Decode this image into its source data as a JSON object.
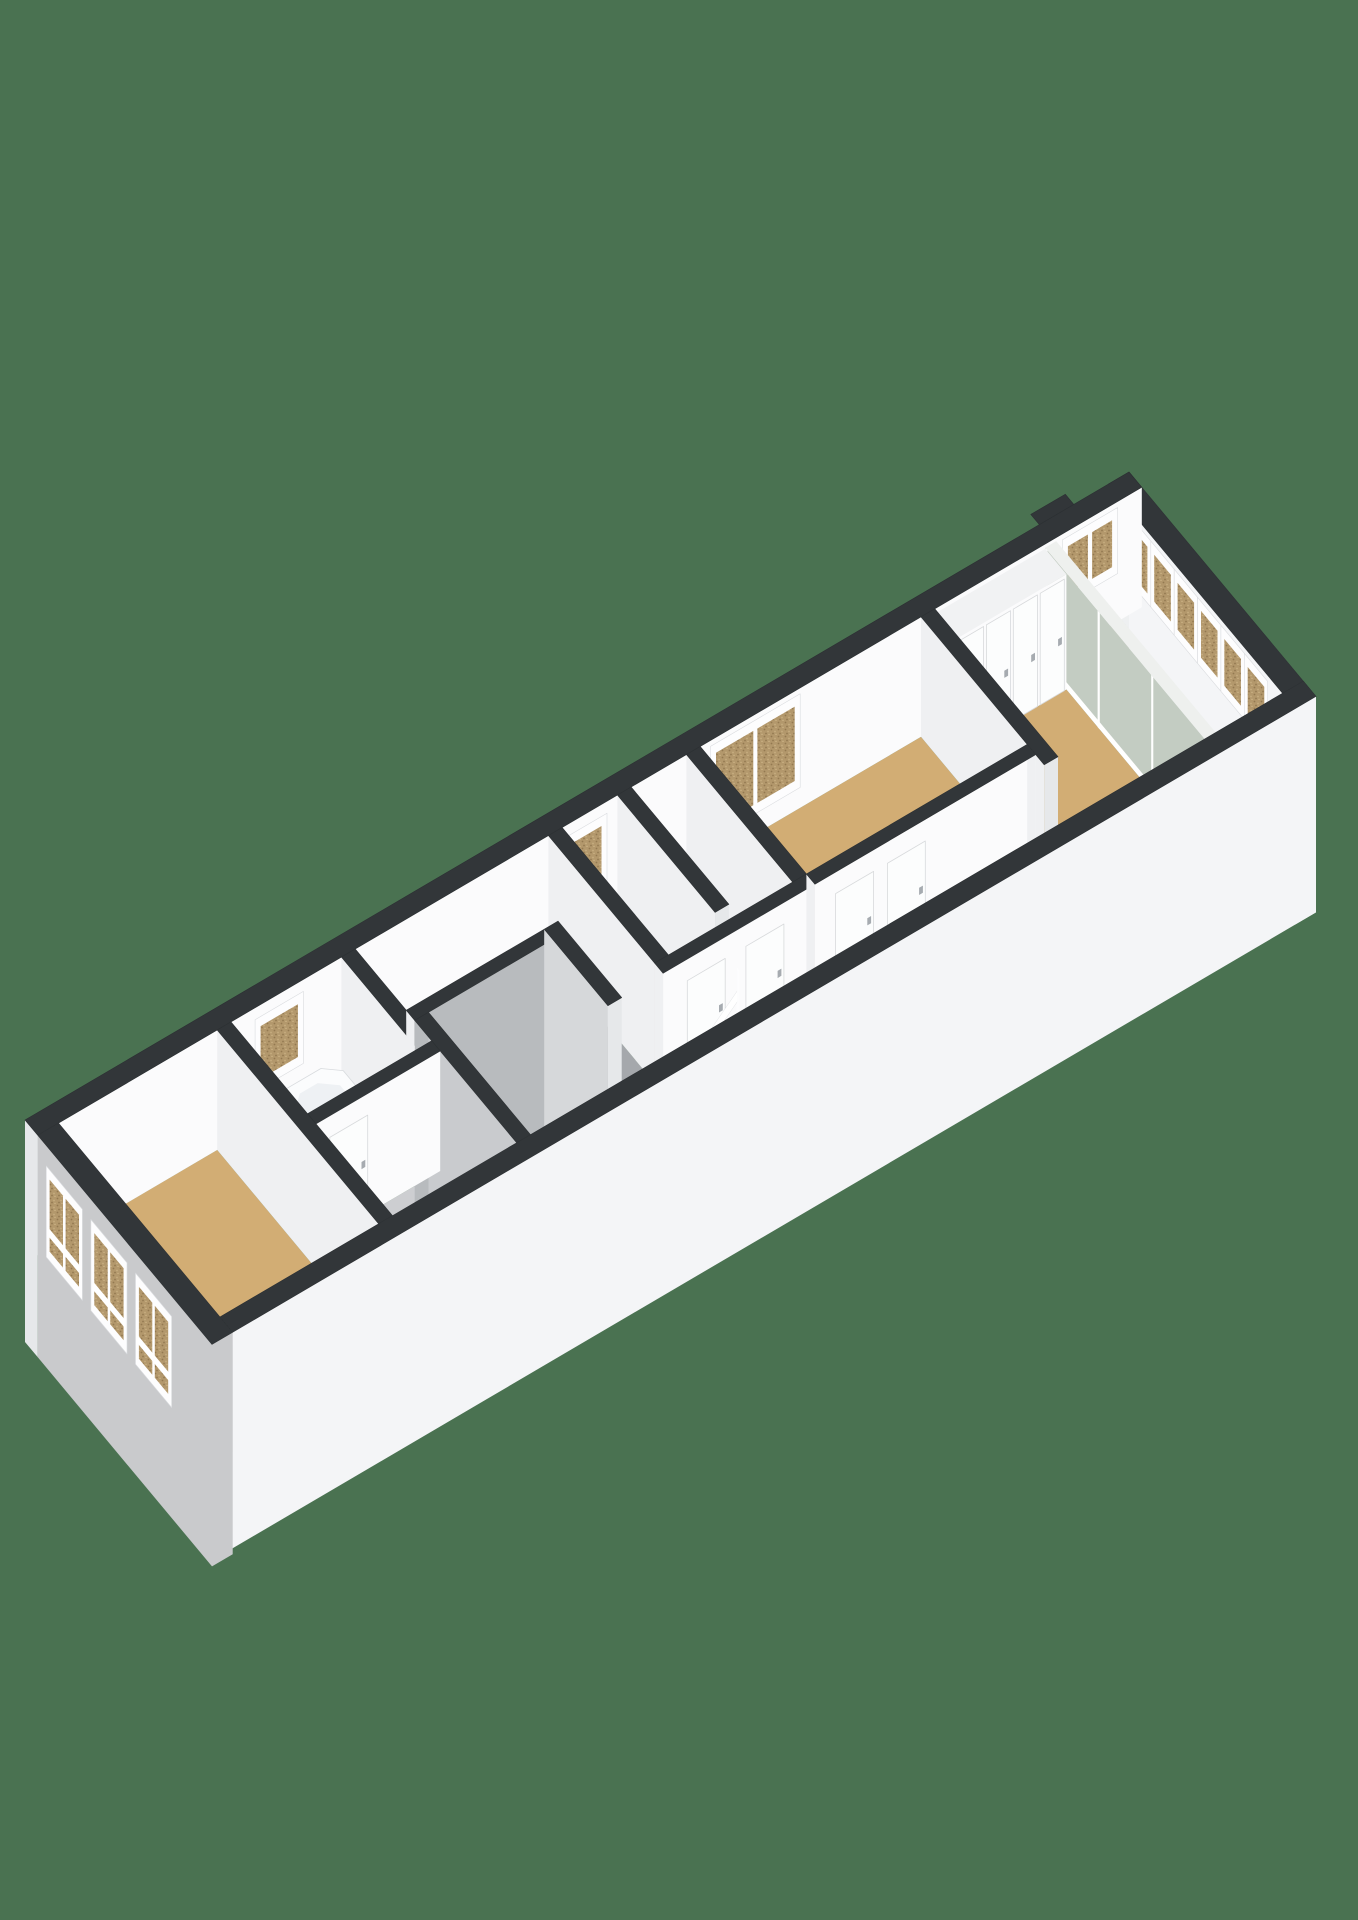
{
  "image_kind": "3d-floorplan-render",
  "visible_text": [],
  "colors": {
    "bg": "#4a7251",
    "darkTop": "#323639",
    "darkTopEdge": "#2c3033",
    "white": "#ffffff",
    "facade": "#c9cacc",
    "faceOuterWhite": "#f4f5f7",
    "faceInnerWhite": "#fbfbfc",
    "faceInnerLight": "#eef0f1",
    "faceInnerGray": "#a7aaae",
    "faceSideLight": "#eff0f2",
    "faceEnd": "#e6e8ea",
    "wardrobeTop": "#f1f2f3",
    "voidFaceA": "#b8bbbe",
    "voidFaceB": "#d6d8da",
    "voidFaceC": "#c9cbce",
    "glassGreen": "#c3ccc2",
    "glassGray": "#cfd6dc",
    "glassTopRail": "#eef0ee",
    "floorTan": "#d2ad74",
    "floorBath": "#c8d2dd",
    "floorHallLight": "#cdced1",
    "floorHallMid": "#bfc1c4",
    "floorHallDark": "#a5a8ac",
    "floorBalcony": "#b6b8aa",
    "treadA": "#f4f5f7",
    "treadB": "#eceef0",
    "treadNose": "#f0f2f4",
    "riser": "#dfe2e4",
    "doorLeaf": "#fcfdfd",
    "doorEdge": "#d8dadc",
    "handle": "#a6abb0",
    "winFrame": "#fdfdfe",
    "winFrameEdge": "#dadcdf",
    "glassSpeckBase": "#b3986c",
    "glassSpeckDark": "#937950",
    "glassSpeckLight": "#c7ad80",
    "carpetBase": "#a49e92",
    "carpetDark": "#8b857a",
    "carpetLight": "#b5afa3",
    "tubOuter": "#fbfcfd",
    "tubRim": "#d8dbde",
    "tubInner": "#eef1f4",
    "tubFloor": "#e6eaee",
    "tubSideS": "#eff1f3",
    "tubSideW": "#f4f6f8"
  },
  "scene": {
    "proj": {
      "ox": 25,
      "oy": 1240,
      "ax": 6.9,
      "ay": -4.05,
      "bx": 4.25,
      "by": 5.1,
      "ez": 120
    },
    "build": [
      {
        "t": "floor",
        "name": "floor-bedroom-front",
        "r": [
          3,
          3,
          26,
          41
        ],
        "f": "floorTan"
      },
      {
        "t": "floor",
        "name": "floor-bathroom",
        "r": [
          28,
          3,
          44,
          21
        ],
        "f": "floorBath"
      },
      {
        "t": "floor",
        "name": "floor-hall-west",
        "r": [
          28,
          23,
          46,
          41
        ],
        "f": "floorHallLight"
      },
      {
        "t": "floor",
        "name": "floor-hall-north",
        "r": [
          46,
          3,
          74,
          15
        ],
        "f": "floorHallMid"
      },
      {
        "t": "floor",
        "name": "floor-hall-east",
        "r": [
          68,
          15,
          74,
          30
        ],
        "f": "floorHallDark"
      },
      {
        "t": "floor",
        "name": "floor-closet-a",
        "r": [
          76,
          3,
          84,
          26
        ],
        "f": "floorHallMid"
      },
      {
        "t": "floor",
        "name": "floor-closet-b",
        "r": [
          86,
          3,
          94,
          26
        ],
        "f": "floorHallLight"
      },
      {
        "t": "floor",
        "name": "floor-bedroom-middle",
        "r": [
          96,
          3,
          128,
          28
        ],
        "f": "floorTan"
      },
      {
        "t": "floor",
        "name": "floor-stair-landing",
        "r": [
          84,
          30,
          96,
          41
        ],
        "f": "floorTan"
      },
      {
        "t": "floor",
        "name": "floor-corridor",
        "r": [
          96,
          30,
          128,
          41
        ],
        "f": "floorHallDark"
      },
      {
        "t": "floor",
        "name": "floor-bedroom-back",
        "r": [
          130,
          8,
          146,
          41
        ],
        "f": "floorTan"
      },
      {
        "t": "floor",
        "name": "floor-balcony",
        "r": [
          147.6,
          3,
          157,
          41
        ],
        "f": "floorBalcony"
      },
      {
        "t": "wall",
        "name": "wall-exterior-northeast",
        "r": [
          157,
          0,
          160,
          44
        ],
        "h": 1,
        "top": "darkTop",
        "faces": [
          {
            "s": "W",
            "f": "faceInnerLight"
          },
          {
            "s": "E",
            "f": "faceOuterWhite",
            "b": -0.8
          },
          {
            "s": "S",
            "f": "faceOuterWhite",
            "b": -0.8
          }
        ]
      },
      {
        "t": "wins",
        "name": "balcony-window-band",
        "plane": "x",
        "at": 157,
        "z": [
          0.45,
          0.9
        ],
        "glass": "gspeck",
        "items": [
          {
            "span": [
              5,
              9.5
            ]
          },
          {
            "span": [
              10.5,
              15
            ]
          },
          {
            "span": [
              16,
              20.5
            ]
          },
          {
            "span": [
              21.5,
              26
            ]
          },
          {
            "span": [
              27,
              31.5
            ]
          },
          {
            "span": [
              32.5,
              37
            ]
          }
        ]
      },
      {
        "t": "wall",
        "name": "wall-exterior-northwest",
        "r": [
          0,
          0,
          160,
          3
        ],
        "h": 1,
        "top": "darkTop",
        "faces": [
          {
            "s": "W",
            "f": "faceEnd",
            "b": -0.85
          },
          {
            "s": "S",
            "f": "faceInnerWhite"
          }
        ]
      },
      {
        "t": "wins",
        "name": "bathroom-window",
        "plane": "y",
        "at": 3,
        "z": [
          0.35,
          0.85
        ],
        "glass": "gspeck",
        "items": [
          {
            "span": [
              32,
              38
            ]
          }
        ]
      },
      {
        "t": "wins",
        "name": "closet-window",
        "plane": "y",
        "at": 3,
        "z": [
          0.3,
          0.85
        ],
        "glass": "gspeck",
        "items": [
          {
            "span": [
              76,
              82
            ]
          }
        ]
      },
      {
        "t": "wins",
        "name": "bedroom-middle-window",
        "plane": "y",
        "at": 3,
        "z": [
          0.22,
          0.9
        ],
        "glass": "gspeck",
        "items": [
          {
            "span": [
              98,
              110
            ],
            "mull": [
              104
            ]
          }
        ]
      },
      {
        "t": "wins",
        "name": "balcony-corner-window",
        "plane": "y",
        "at": 3,
        "z": [
          0.45,
          0.9
        ],
        "glass": "gspeck",
        "items": [
          {
            "span": [
              149,
              156
            ],
            "mull": [
              152.5
            ]
          }
        ]
      },
      {
        "t": "top",
        "name": "roof-vent",
        "r": [
          147,
          -2,
          152,
          0
        ],
        "z": 1,
        "f": "darkTop"
      },
      {
        "t": "glasswall",
        "name": "glass-sliding-wall",
        "r": [
          146,
          3,
          147.6,
          41
        ],
        "h": 0.97,
        "divs": [
          3.3,
          15.6,
          28.2,
          40.7
        ]
      },
      {
        "t": "wall",
        "name": "wardrobe",
        "r": [
          130,
          3,
          146,
          8
        ],
        "h": 0.96,
        "top": "wardrobeTop",
        "faces": [
          {
            "s": "W",
            "f": "faceOuterWhite"
          },
          {
            "s": "S",
            "f": "faceInnerWhite"
          }
        ]
      },
      {
        "t": "doors",
        "name": "wardrobe-door",
        "plane": "y",
        "at": 8,
        "h": 0.93,
        "items": [
          [
            130.5,
            134
          ],
          [
            134.4,
            137.9
          ],
          [
            138.3,
            141.8
          ],
          [
            142.2,
            145.7
          ]
        ]
      },
      {
        "t": "wall",
        "name": "wall-back-bedroom-west",
        "r": [
          128,
          3,
          130,
          32
        ],
        "h": 1,
        "top": "darkTop",
        "faces": [
          {
            "s": "W",
            "f": "faceSideLight"
          },
          {
            "s": "S",
            "f": "faceEnd"
          }
        ]
      },
      {
        "t": "wall",
        "name": "wall-bedroom-middle-east",
        "r": [
          94,
          3,
          96,
          28
        ],
        "h": 1,
        "top": "darkTop",
        "faces": [
          {
            "s": "W",
            "f": "faceSideLight"
          },
          {
            "s": "S",
            "f": "faceEnd"
          }
        ]
      },
      {
        "t": "wall",
        "name": "wall-closet-divider",
        "r": [
          84,
          3,
          86,
          26
        ],
        "h": 1,
        "top": "darkTop",
        "faces": [
          {
            "s": "W",
            "f": "faceSideLight"
          },
          {
            "s": "S",
            "f": "faceEnd"
          }
        ]
      },
      {
        "t": "wall",
        "name": "wall-hall-closet",
        "r": [
          74,
          3,
          76,
          28
        ],
        "h": 1,
        "top": "darkTop",
        "faces": [
          {
            "s": "W",
            "f": "faceSideLight"
          },
          {
            "s": "S",
            "f": "faceEnd"
          }
        ]
      },
      {
        "t": "wall",
        "name": "wall-bathroom-east",
        "r": [
          44,
          3,
          46,
          21
        ],
        "h": 1,
        "top": "darkTop",
        "faces": [
          {
            "s": "W",
            "f": "faceSideLight"
          },
          {
            "s": "S",
            "f": "faceEnd"
          }
        ]
      },
      {
        "t": "wall",
        "name": "shower-screen",
        "r": [
          29,
          4.5,
          30.2,
          12
        ],
        "h": 0.55,
        "top": "white",
        "faces": [
          {
            "s": "W",
            "f": "glassGray"
          },
          {
            "s": "S",
            "f": "glassGray"
          }
        ]
      },
      {
        "t": "wall",
        "name": "stairwell-wall-north",
        "r": [
          46,
          15,
          66,
          17
        ],
        "h": 1,
        "top": "darkTop",
        "faces": [
          {
            "s": "S",
            "f": "voidFaceA",
            "b": -0.95
          },
          {
            "s": "W",
            "f": "faceSideLight"
          }
        ]
      },
      {
        "t": "wall",
        "name": "stairwell-wall-east",
        "r": [
          66,
          15,
          68,
          30
        ],
        "h": 1,
        "top": "darkTop",
        "faces": [
          {
            "s": "W",
            "f": "voidFaceB",
            "b": -0.95
          },
          {
            "s": "S",
            "f": "faceEnd",
            "b": -0.95
          }
        ]
      },
      {
        "t": "wall",
        "name": "stairwell-wall-west",
        "r": [
          46,
          17,
          48,
          41
        ],
        "h": 1,
        "top": "darkTop",
        "faces": [
          {
            "s": "E",
            "f": "voidFaceC",
            "b": -0.95
          },
          {
            "s": "S",
            "f": "faceInnerWhite"
          }
        ]
      },
      {
        "t": "top",
        "name": "stair-carpet",
        "r": [
          48,
          30,
          55.5,
          41
        ],
        "z": -0.75,
        "f": "url(#carpet)"
      },
      {
        "t": "wall",
        "name": "wall-closet-south",
        "r": [
          74,
          28,
          96,
          30
        ],
        "h": 1,
        "top": "darkTop",
        "faces": [
          {
            "s": "W",
            "f": "faceSideLight"
          },
          {
            "s": "S",
            "f": "faceInnerWhite"
          }
        ]
      },
      {
        "t": "doors",
        "name": "closet-door",
        "plane": "y",
        "at": 30,
        "h": 0.82,
        "items": [
          [
            77.5,
            83
          ],
          [
            86,
            91.5
          ]
        ]
      },
      {
        "t": "wall",
        "name": "wall-bedroom-middle-south",
        "r": [
          96,
          28,
          128,
          30
        ],
        "h": 1,
        "top": "darkTop",
        "faces": [
          {
            "s": "W",
            "f": "faceSideLight"
          },
          {
            "s": "S",
            "f": "faceInnerWhite"
          },
          {
            "s": "E",
            "f": "faceSideLight"
          }
        ]
      },
      {
        "t": "doors",
        "name": "bedroom-middle-door",
        "plane": "y",
        "at": 30,
        "h": 0.82,
        "items": [
          [
            99,
            104.5
          ],
          [
            106.5,
            112
          ]
        ]
      },
      {
        "t": "stairs",
        "name": "staircase",
        "x0": 84,
        "n": 8,
        "w": 2.1,
        "y": [
          30,
          41
        ],
        "z0": -0.06,
        "dz": 0.105
      },
      {
        "t": "rail",
        "name": "stair-balustrade",
        "x": [
          67.2,
          84.6
        ],
        "y": 30.5,
        "posts": 9,
        "ph": 0.56,
        "x0": 84,
        "w": 2.1,
        "z0": -0.06,
        "dz": 0.105
      },
      {
        "t": "tub",
        "name": "bathtub",
        "r": [
          32.5,
          5.5,
          41.5,
          18.5
        ]
      },
      {
        "t": "wall",
        "name": "wall-bathroom-south",
        "r": [
          28,
          21,
          46,
          23
        ],
        "h": 1,
        "top": "darkTop",
        "faces": [
          {
            "s": "W",
            "f": "faceSideLight"
          },
          {
            "s": "S",
            "f": "faceInnerWhite"
          }
        ]
      },
      {
        "t": "doors",
        "name": "bathroom-door",
        "plane": "y",
        "at": 23,
        "h": 0.82,
        "items": [
          [
            30,
            35.5
          ]
        ]
      },
      {
        "t": "wall",
        "name": "wall-bedroom-front-east",
        "r": [
          26,
          3,
          28,
          41
        ],
        "h": 1,
        "top": "darkTop",
        "faces": [
          {
            "s": "W",
            "f": "faceSideLight"
          },
          {
            "s": "S",
            "f": "faceInnerWhite"
          }
        ]
      },
      {
        "t": "wall",
        "name": "wall-exterior-southeast",
        "r": [
          0,
          41,
          160,
          44
        ],
        "h": 1,
        "top": "darkTop",
        "faces": [
          {
            "s": "N",
            "f": "faceInnerGray"
          },
          {
            "s": "E",
            "f": "faceOuterWhite",
            "b": -0.8
          },
          {
            "s": "S",
            "f": "faceOuterWhite",
            "b": -0.8
          }
        ]
      },
      {
        "t": "wall",
        "name": "wall-exterior-southwest-facade",
        "r": [
          0,
          3,
          3,
          44
        ],
        "h": 1,
        "top": "darkTop",
        "faces": [
          {
            "s": "E",
            "f": "faceInnerLight"
          },
          {
            "s": "N",
            "f": "faceEnd"
          },
          {
            "s": "W",
            "f": "facade",
            "b": -0.85
          },
          {
            "s": "S",
            "f": "facade",
            "b": -0.85
          }
        ]
      },
      {
        "t": "wins",
        "name": "facade-window",
        "plane": "x",
        "at": 0,
        "z": [
          0.12,
          0.78
        ],
        "glass": "gspeck",
        "rail": 0.3,
        "items": [
          {
            "span": [
              5.5,
              13
            ],
            "mull": [
              9.25
            ]
          },
          {
            "span": [
              16,
              23.5
            ],
            "mull": [
              19.75
            ]
          },
          {
            "span": [
              26.5,
              34
            ],
            "mull": [
              30.25
            ]
          }
        ]
      }
    ]
  }
}
